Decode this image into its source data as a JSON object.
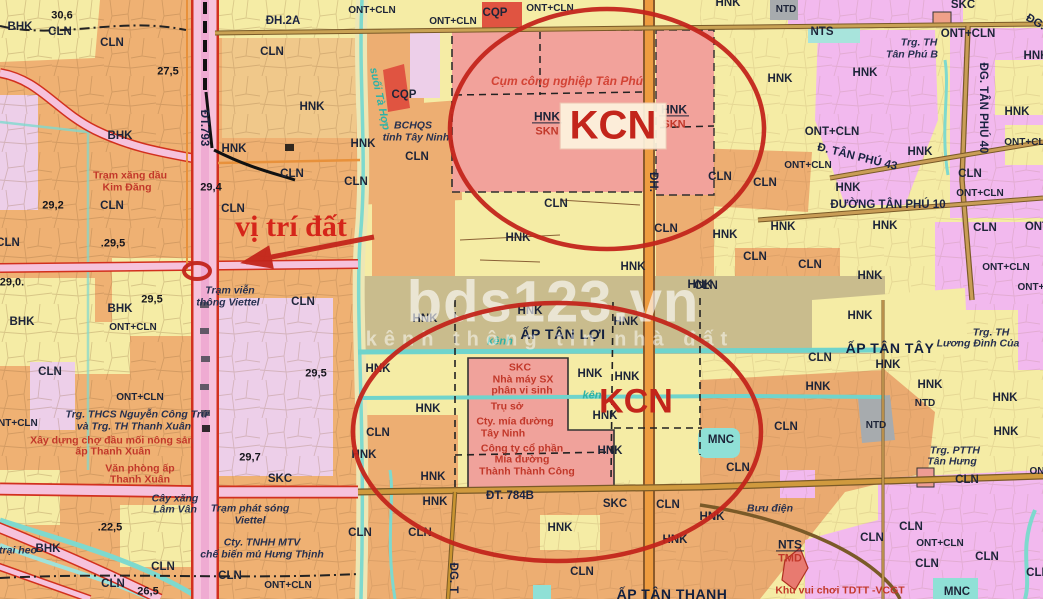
{
  "map": {
    "annotations": {
      "location_label": "vị trí đất",
      "kcn_top": "KCN",
      "kcn_bottom": "KCN"
    },
    "watermark": {
      "brand": "bds123.vn",
      "tagline": "kênh thông tin nhà đất"
    },
    "palette": {
      "annotation_red": "#c3251b",
      "industrial_salmon": "#F2A29B",
      "crop_orange_CLN": "#EFB173",
      "crop_yellow_HNK": "#F5ECA5",
      "residential_pink_ONT": "#F2B9EE",
      "lavender": "#EDCFE9",
      "hamlet_olive": "#C9BC8D",
      "water_teal": "#7ED9CE",
      "cemetery_gray_NTD": "#A7ABAE",
      "defense_red_CQP": "#E05441",
      "road_pink": "#F6C2DC",
      "road_red_edge": "#D2301E",
      "road_orange": "#EE9C40"
    },
    "map_labels": [
      {
        "t": "30,6",
        "x": 62,
        "y": 16,
        "k": "num"
      },
      {
        "t": "BHK",
        "x": 20,
        "y": 28,
        "k": "code"
      },
      {
        "t": "CLN",
        "x": 60,
        "y": 33,
        "k": "code"
      },
      {
        "t": "CLN",
        "x": 112,
        "y": 44,
        "k": "code"
      },
      {
        "t": "27,5",
        "x": 168,
        "y": 72,
        "k": "num"
      },
      {
        "t": "ĐH.2A",
        "x": 283,
        "y": 22,
        "k": "road"
      },
      {
        "t": "CLN",
        "x": 272,
        "y": 53,
        "k": "code"
      },
      {
        "t": "HNK",
        "x": 312,
        "y": 108,
        "k": "code"
      },
      {
        "t": "ĐT.793",
        "x": 203,
        "y": 128,
        "k": "road",
        "r": 90
      },
      {
        "t": "BHK",
        "x": 120,
        "y": 137,
        "k": "code"
      },
      {
        "t": "HNK",
        "x": 234,
        "y": 150,
        "k": "code"
      },
      {
        "t": "CLN",
        "x": 292,
        "y": 175,
        "k": "code"
      },
      {
        "t": "Trạm xăng dầu",
        "x": 130,
        "y": 176,
        "k": "redS"
      },
      {
        "t": "Kim Đăng",
        "x": 127,
        "y": 188,
        "k": "redS"
      },
      {
        "t": "29,4",
        "x": 211,
        "y": 188,
        "k": "num"
      },
      {
        "t": "29,2",
        "x": 53,
        "y": 206,
        "k": "num"
      },
      {
        "t": "CLN",
        "x": 112,
        "y": 207,
        "k": "code"
      },
      {
        "t": "CLN",
        "x": 233,
        "y": 210,
        "k": "code"
      },
      {
        "t": ".29,5",
        "x": 113,
        "y": 244,
        "k": "num"
      },
      {
        "t": "CLN",
        "x": 8,
        "y": 244,
        "k": "code"
      },
      {
        "t": "29,0.",
        "x": 12,
        "y": 283,
        "k": "num"
      },
      {
        "t": "Trạm viễn",
        "x": 230,
        "y": 291,
        "k": "place"
      },
      {
        "t": "thông Viettel",
        "x": 228,
        "y": 303,
        "k": "place"
      },
      {
        "t": "CLN",
        "x": 303,
        "y": 303,
        "k": "code"
      },
      {
        "t": "29,5",
        "x": 152,
        "y": 300,
        "k": "num"
      },
      {
        "t": "BHK",
        "x": 120,
        "y": 310,
        "k": "code"
      },
      {
        "t": "BHK",
        "x": 22,
        "y": 323,
        "k": "code"
      },
      {
        "t": "ONT+CLN",
        "x": 133,
        "y": 328,
        "k": "codeS"
      },
      {
        "t": "CLN",
        "x": 50,
        "y": 373,
        "k": "code"
      },
      {
        "t": "29,5",
        "x": 316,
        "y": 374,
        "k": "num"
      },
      {
        "t": "ONT+CLN",
        "x": 140,
        "y": 398,
        "k": "codeS"
      },
      {
        "t": "Trg. THCS Nguyễn Công Trứ",
        "x": 137,
        "y": 415,
        "k": "place"
      },
      {
        "t": "và Trg. TH Thanh Xuân",
        "x": 134,
        "y": 427,
        "k": "place"
      },
      {
        "t": "ONT+CLN",
        "x": 14,
        "y": 424,
        "k": "codeS"
      },
      {
        "t": "Xây dựng chợ đầu mối nông sản",
        "x": 112,
        "y": 441,
        "k": "redS"
      },
      {
        "t": "ấp Thanh Xuân",
        "x": 113,
        "y": 452,
        "k": "redS"
      },
      {
        "t": "Văn phòng ấp",
        "x": 140,
        "y": 469,
        "k": "redS"
      },
      {
        "t": "Thanh Xuân",
        "x": 140,
        "y": 480,
        "k": "redS"
      },
      {
        "t": "29,7",
        "x": 250,
        "y": 458,
        "k": "num"
      },
      {
        "t": "SKC",
        "x": 280,
        "y": 480,
        "k": "code"
      },
      {
        "t": "Cây xăng",
        "x": 175,
        "y": 499,
        "k": "place"
      },
      {
        "t": "Lâm Vân",
        "x": 175,
        "y": 510,
        "k": "place"
      },
      {
        "t": "Trạm phát sóng",
        "x": 250,
        "y": 509,
        "k": "place"
      },
      {
        "t": "Viettel",
        "x": 250,
        "y": 521,
        "k": "place"
      },
      {
        "t": ".22,5",
        "x": 110,
        "y": 528,
        "k": "num"
      },
      {
        "t": "trại heo",
        "x": 18,
        "y": 551,
        "k": "place"
      },
      {
        "t": "BHK",
        "x": 48,
        "y": 550,
        "k": "code"
      },
      {
        "t": "Cty. TNHH MTV",
        "x": 262,
        "y": 543,
        "k": "place"
      },
      {
        "t": "chế biến mủ Hưng Thịnh",
        "x": 262,
        "y": 555,
        "k": "place"
      },
      {
        "t": "CLN",
        "x": 163,
        "y": 568,
        "k": "code"
      },
      {
        "t": "CLN",
        "x": 230,
        "y": 577,
        "k": "code"
      },
      {
        "t": "CLN",
        "x": 113,
        "y": 585,
        "k": "code"
      },
      {
        "t": "26,5",
        "x": 148,
        "y": 592,
        "k": "num"
      },
      {
        "t": "ONT+CLN",
        "x": 288,
        "y": 586,
        "k": "codeS"
      },
      {
        "t": "ONT+CLN",
        "x": 372,
        "y": 11,
        "k": "codeS"
      },
      {
        "t": "ONT+CLN",
        "x": 453,
        "y": 22,
        "k": "codeS"
      },
      {
        "t": "CQP",
        "x": 495,
        "y": 14,
        "k": "code"
      },
      {
        "t": "ONT+CLN",
        "x": 550,
        "y": 9,
        "k": "codeS"
      },
      {
        "t": "Cụm công nghiệp Tân Phú",
        "x": 567,
        "y": 81,
        "k": "redI"
      },
      {
        "t": "CQP",
        "x": 404,
        "y": 96,
        "k": "code"
      },
      {
        "t": "suối Tà Hợp",
        "x": 379,
        "y": 99,
        "k": "teal",
        "r": 78
      },
      {
        "t": "HNK",
        "x": 547,
        "y": 117,
        "k": "frT"
      },
      {
        "t": "SKN",
        "x": 547,
        "y": 132,
        "k": "frB"
      },
      {
        "t": "HNK",
        "x": 674,
        "y": 110,
        "k": "frT"
      },
      {
        "t": "SKN",
        "x": 674,
        "y": 125,
        "k": "frB"
      },
      {
        "t": "BCHQS",
        "x": 413,
        "y": 126,
        "k": "place"
      },
      {
        "t": "tỉnh Tây Ninh",
        "x": 416,
        "y": 138,
        "k": "place"
      },
      {
        "t": "HNK",
        "x": 363,
        "y": 145,
        "k": "code"
      },
      {
        "t": "CLN",
        "x": 417,
        "y": 158,
        "k": "code"
      },
      {
        "t": "ĐH.",
        "x": 652,
        "y": 182,
        "k": "road",
        "r": 90
      },
      {
        "t": "CLN",
        "x": 356,
        "y": 183,
        "k": "code"
      },
      {
        "t": "CLN",
        "x": 556,
        "y": 205,
        "k": "code"
      },
      {
        "t": "HNK",
        "x": 518,
        "y": 239,
        "k": "code"
      },
      {
        "t": "CLN",
        "x": 666,
        "y": 230,
        "k": "code"
      },
      {
        "t": "HNK",
        "x": 633,
        "y": 268,
        "k": "code"
      },
      {
        "t": "HNK",
        "x": 700,
        "y": 286,
        "k": "code"
      },
      {
        "t": "HNK",
        "x": 425,
        "y": 320,
        "k": "code"
      },
      {
        "t": "HNK",
        "x": 530,
        "y": 312,
        "k": "code"
      },
      {
        "t": "HNK",
        "x": 626,
        "y": 323,
        "k": "code"
      },
      {
        "t": "ẤP TÂN LỢI",
        "x": 563,
        "y": 334,
        "k": "ap"
      },
      {
        "t": "kênh",
        "x": 500,
        "y": 342,
        "k": "teal"
      },
      {
        "t": "HNK",
        "x": 378,
        "y": 370,
        "k": "code"
      },
      {
        "t": "SKC",
        "x": 520,
        "y": 368,
        "k": "redS"
      },
      {
        "t": "Nhà máy SX",
        "x": 523,
        "y": 380,
        "k": "redS"
      },
      {
        "t": "phân vi sinh",
        "x": 522,
        "y": 391,
        "k": "redS"
      },
      {
        "t": "HNK",
        "x": 590,
        "y": 375,
        "k": "code"
      },
      {
        "t": "HNK",
        "x": 627,
        "y": 378,
        "k": "code"
      },
      {
        "t": "kên",
        "x": 592,
        "y": 396,
        "k": "teal"
      },
      {
        "t": "HNK",
        "x": 428,
        "y": 410,
        "k": "code"
      },
      {
        "t": "Trụ sở",
        "x": 507,
        "y": 407,
        "k": "redS"
      },
      {
        "t": "Cty. mía đường",
        "x": 515,
        "y": 422,
        "k": "redS"
      },
      {
        "t": "Tây Ninh",
        "x": 503,
        "y": 434,
        "k": "redS"
      },
      {
        "t": "HNK",
        "x": 605,
        "y": 417,
        "k": "code"
      },
      {
        "t": "CLN",
        "x": 378,
        "y": 434,
        "k": "code"
      },
      {
        "t": "Công ty cổ phần",
        "x": 522,
        "y": 449,
        "k": "redS"
      },
      {
        "t": "Mía đường",
        "x": 522,
        "y": 460,
        "k": "redS"
      },
      {
        "t": "Thành Thành Công",
        "x": 527,
        "y": 472,
        "k": "redS"
      },
      {
        "t": "HNK",
        "x": 610,
        "y": 452,
        "k": "code"
      },
      {
        "t": "HNK",
        "x": 364,
        "y": 456,
        "k": "code"
      },
      {
        "t": "HNK",
        "x": 433,
        "y": 478,
        "k": "code"
      },
      {
        "t": "ĐT. 784B",
        "x": 510,
        "y": 497,
        "k": "road"
      },
      {
        "t": "SKC",
        "x": 615,
        "y": 505,
        "k": "code"
      },
      {
        "t": "CLN",
        "x": 668,
        "y": 506,
        "k": "code"
      },
      {
        "t": "HNK",
        "x": 435,
        "y": 503,
        "k": "code"
      },
      {
        "t": "CLN",
        "x": 360,
        "y": 534,
        "k": "code"
      },
      {
        "t": "CLN",
        "x": 420,
        "y": 534,
        "k": "code"
      },
      {
        "t": "HNK",
        "x": 560,
        "y": 529,
        "k": "code"
      },
      {
        "t": "HNK",
        "x": 675,
        "y": 541,
        "k": "code"
      },
      {
        "t": "CLN",
        "x": 582,
        "y": 573,
        "k": "code"
      },
      {
        "t": "ĐG. T",
        "x": 452,
        "y": 578,
        "k": "road",
        "r": 90
      },
      {
        "t": "ẤP TÂN THẠNH",
        "x": 672,
        "y": 594,
        "k": "ap"
      },
      {
        "t": "Khu vui chơi TDTT -VCGT",
        "x": 840,
        "y": 591,
        "k": "redS"
      },
      {
        "t": "HNK",
        "x": 728,
        "y": 4,
        "k": "code"
      },
      {
        "t": "NTD",
        "x": 786,
        "y": 10,
        "k": "codeS"
      },
      {
        "t": "SKC",
        "x": 963,
        "y": 6,
        "k": "code"
      },
      {
        "t": "ĐG.",
        "x": 1035,
        "y": 23,
        "k": "road",
        "r": 30
      },
      {
        "t": "NTS",
        "x": 822,
        "y": 33,
        "k": "code"
      },
      {
        "t": "ONT+CLN",
        "x": 968,
        "y": 35,
        "k": "code"
      },
      {
        "t": "Trg. TH",
        "x": 919,
        "y": 43,
        "k": "place"
      },
      {
        "t": "Tân Phú B",
        "x": 912,
        "y": 55,
        "k": "place"
      },
      {
        "t": "HNK",
        "x": 1036,
        "y": 57,
        "k": "code"
      },
      {
        "t": "HNK",
        "x": 780,
        "y": 80,
        "k": "code"
      },
      {
        "t": "HNK",
        "x": 865,
        "y": 74,
        "k": "code"
      },
      {
        "t": "ĐG. TÂN PHÚ 40",
        "x": 982,
        "y": 108,
        "k": "road",
        "r": 90
      },
      {
        "t": "HNK",
        "x": 1017,
        "y": 113,
        "k": "code"
      },
      {
        "t": "ONT+CLN",
        "x": 832,
        "y": 133,
        "k": "code"
      },
      {
        "t": "ONT+CLN",
        "x": 1028,
        "y": 143,
        "k": "codeS"
      },
      {
        "t": "Đ. TÂN PHÚ 43",
        "x": 857,
        "y": 158,
        "k": "road",
        "r": 14
      },
      {
        "t": "HNK",
        "x": 920,
        "y": 153,
        "k": "code"
      },
      {
        "t": "ONT+CLN",
        "x": 808,
        "y": 166,
        "k": "codeS"
      },
      {
        "t": "CLN",
        "x": 720,
        "y": 178,
        "k": "code"
      },
      {
        "t": "CLN",
        "x": 765,
        "y": 184,
        "k": "code"
      },
      {
        "t": "CLN",
        "x": 970,
        "y": 175,
        "k": "code"
      },
      {
        "t": "ONT+CLN",
        "x": 980,
        "y": 194,
        "k": "codeS"
      },
      {
        "t": "HNK",
        "x": 848,
        "y": 189,
        "k": "code"
      },
      {
        "t": "ĐƯỜNG TÂN PHÚ 10",
        "x": 888,
        "y": 206,
        "k": "road"
      },
      {
        "t": "HNK",
        "x": 725,
        "y": 236,
        "k": "code"
      },
      {
        "t": "HNK",
        "x": 783,
        "y": 228,
        "k": "code"
      },
      {
        "t": "HNK",
        "x": 885,
        "y": 227,
        "k": "code"
      },
      {
        "t": "CLN",
        "x": 985,
        "y": 229,
        "k": "code"
      },
      {
        "t": "ONT",
        "x": 1037,
        "y": 228,
        "k": "code"
      },
      {
        "t": "CLN",
        "x": 755,
        "y": 258,
        "k": "code"
      },
      {
        "t": "CLN",
        "x": 810,
        "y": 266,
        "k": "code"
      },
      {
        "t": "ONT+CLN",
        "x": 1006,
        "y": 268,
        "k": "codeS"
      },
      {
        "t": "HNK",
        "x": 870,
        "y": 277,
        "k": "code"
      },
      {
        "t": "CLN",
        "x": 706,
        "y": 287,
        "k": "code"
      },
      {
        "t": "ONT+",
        "x": 1031,
        "y": 288,
        "k": "codeS"
      },
      {
        "t": "HNK",
        "x": 860,
        "y": 317,
        "k": "code"
      },
      {
        "t": "Trg. TH",
        "x": 991,
        "y": 333,
        "k": "place"
      },
      {
        "t": "Lương Đình Của",
        "x": 978,
        "y": 344,
        "k": "place"
      },
      {
        "t": "ẤP TÂN TÂY",
        "x": 890,
        "y": 348,
        "k": "ap"
      },
      {
        "t": "CLN",
        "x": 820,
        "y": 359,
        "k": "code"
      },
      {
        "t": "HNK",
        "x": 888,
        "y": 366,
        "k": "code"
      },
      {
        "t": "HNK",
        "x": 818,
        "y": 388,
        "k": "code"
      },
      {
        "t": "HNK",
        "x": 930,
        "y": 386,
        "k": "code"
      },
      {
        "t": "NTD",
        "x": 925,
        "y": 404,
        "k": "codeS"
      },
      {
        "t": "HNK",
        "x": 1005,
        "y": 399,
        "k": "code"
      },
      {
        "t": "NTD",
        "x": 876,
        "y": 426,
        "k": "codeS"
      },
      {
        "t": "CLN",
        "x": 786,
        "y": 428,
        "k": "code"
      },
      {
        "t": "MNC",
        "x": 721,
        "y": 441,
        "k": "code"
      },
      {
        "t": "HNK",
        "x": 1006,
        "y": 433,
        "k": "code"
      },
      {
        "t": "Trg. PTTH",
        "x": 955,
        "y": 451,
        "k": "place"
      },
      {
        "t": "Tân Hưng",
        "x": 952,
        "y": 462,
        "k": "place"
      },
      {
        "t": "CLN",
        "x": 738,
        "y": 469,
        "k": "code"
      },
      {
        "t": "CLN",
        "x": 967,
        "y": 481,
        "k": "code"
      },
      {
        "t": "ONT",
        "x": 1040,
        "y": 472,
        "k": "codeS"
      },
      {
        "t": "Bưu điện",
        "x": 770,
        "y": 509,
        "k": "place"
      },
      {
        "t": "HNK",
        "x": 712,
        "y": 518,
        "k": "code"
      },
      {
        "t": "NTS",
        "x": 790,
        "y": 545,
        "k": "frT"
      },
      {
        "t": "TMD",
        "x": 790,
        "y": 559,
        "k": "frB"
      },
      {
        "t": "CLN",
        "x": 872,
        "y": 539,
        "k": "code"
      },
      {
        "t": "CLN",
        "x": 911,
        "y": 528,
        "k": "code"
      },
      {
        "t": "ONT+CLN",
        "x": 940,
        "y": 544,
        "k": "codeS"
      },
      {
        "t": "CLN",
        "x": 927,
        "y": 565,
        "k": "code"
      },
      {
        "t": "CLN",
        "x": 987,
        "y": 558,
        "k": "code"
      },
      {
        "t": "MNC",
        "x": 957,
        "y": 593,
        "k": "code"
      },
      {
        "t": "CLN",
        "x": 1038,
        "y": 574,
        "k": "code"
      }
    ]
  }
}
